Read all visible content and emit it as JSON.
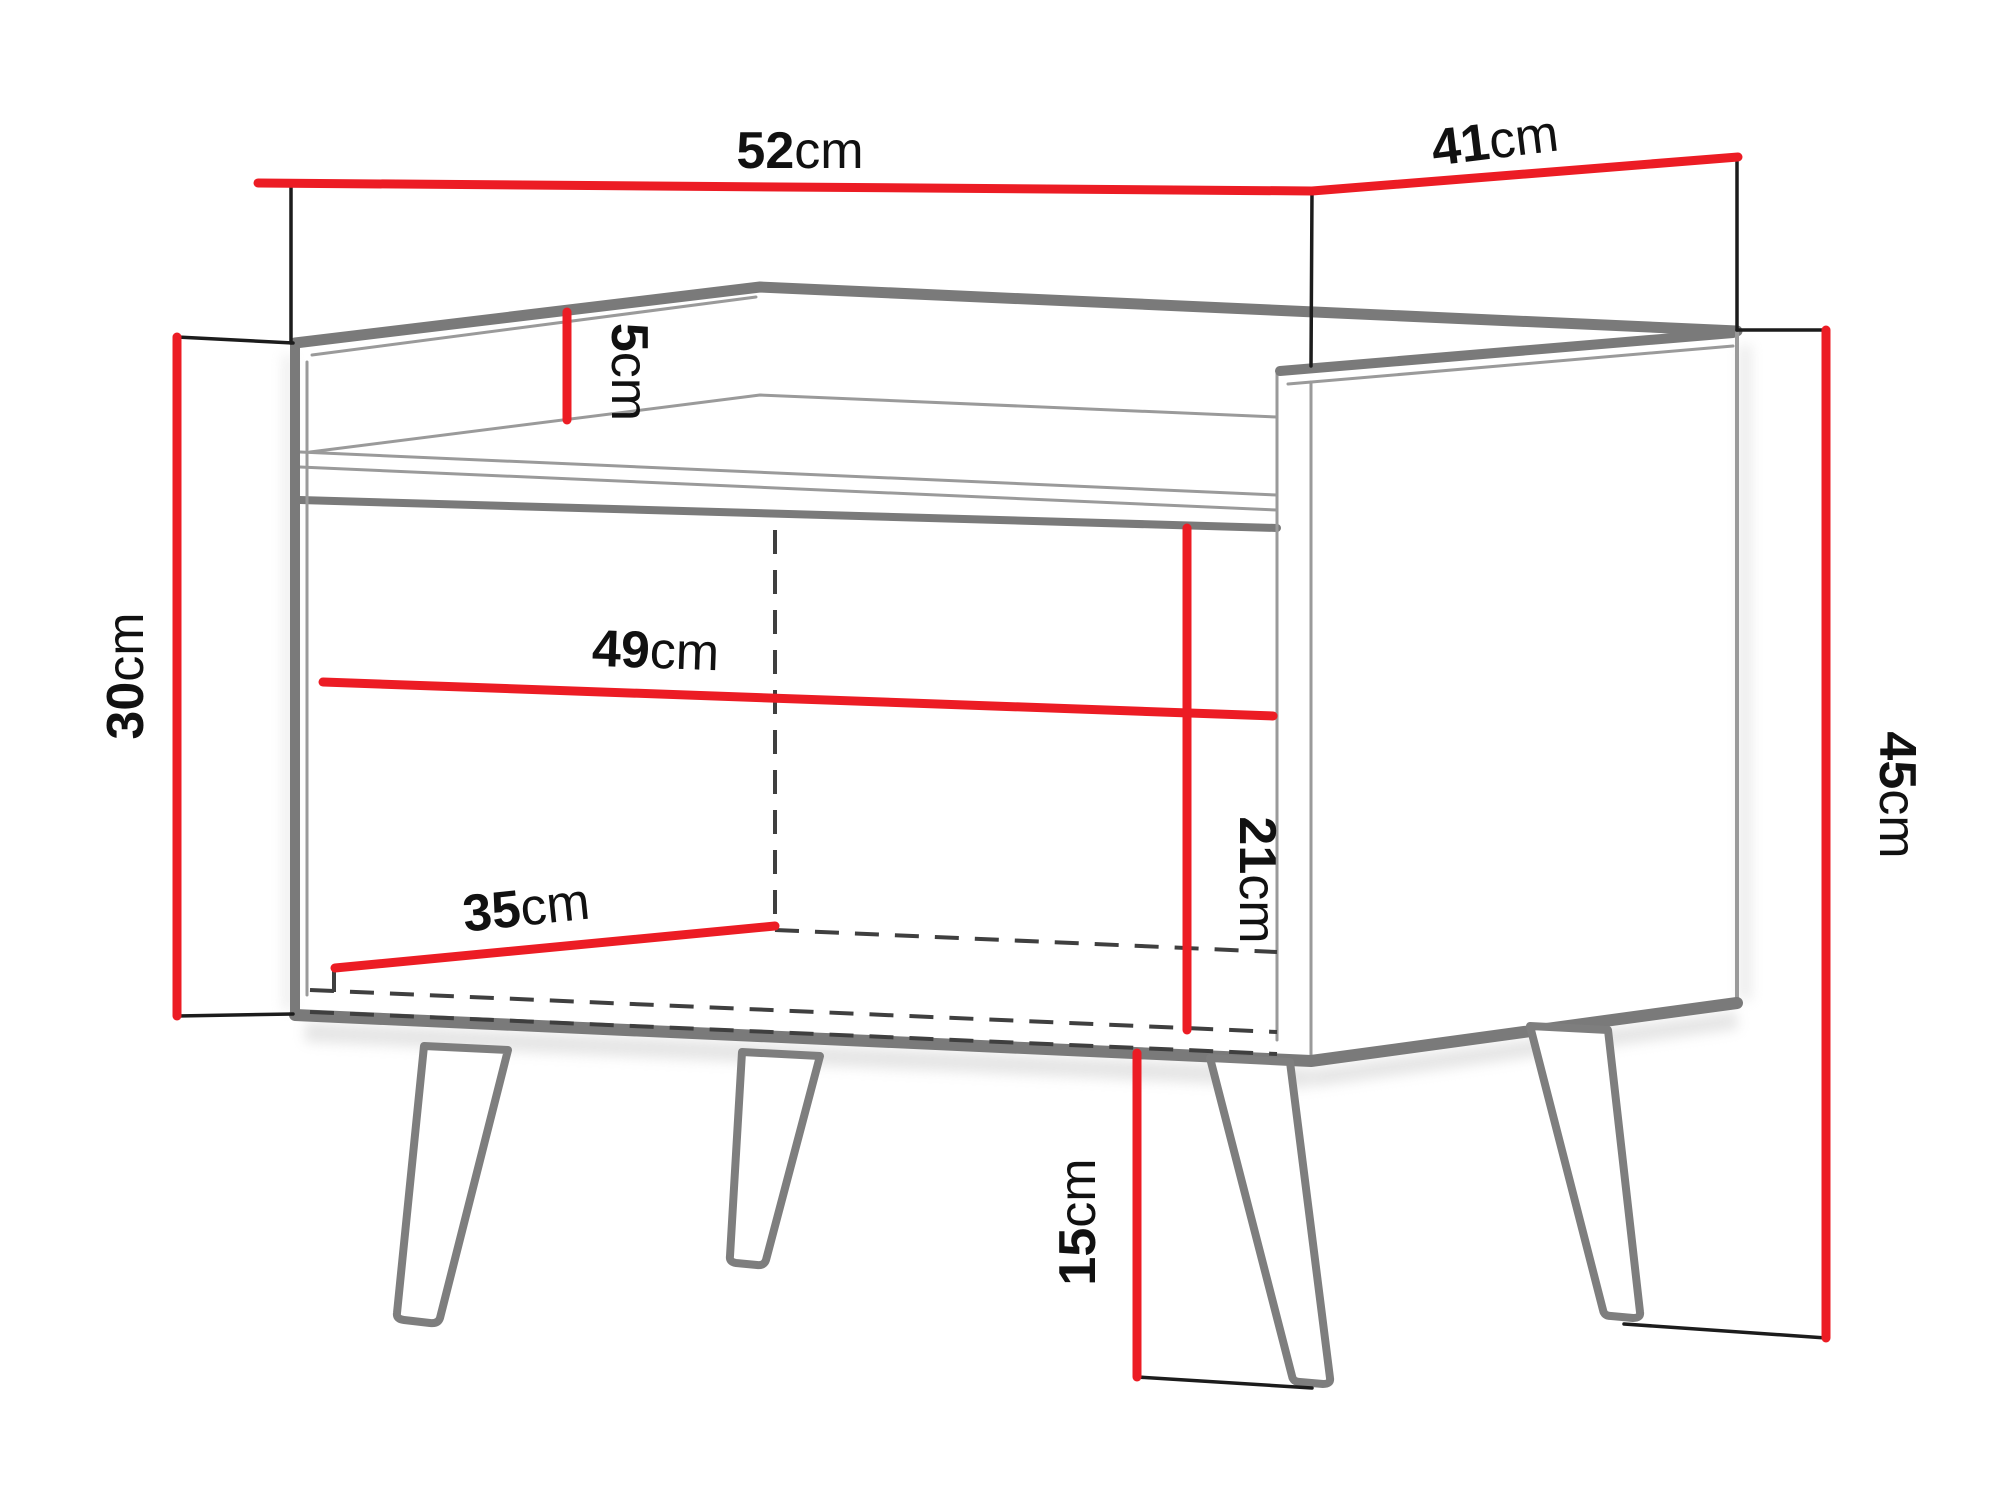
{
  "diagram": {
    "type": "furniture-dimension-drawing",
    "subject": "nightstand with open shelf and four splayed legs",
    "units": "cm",
    "colors": {
      "dimension_line": "#ec1c24",
      "drawing_thick": "#7a7a7a",
      "drawing_thin": "#9a9a9a",
      "extension_line": "#1c1c1c",
      "hidden_dashed": "#3f3f3f",
      "text": "#111111",
      "background": "#ffffff"
    }
  },
  "dimensions": {
    "outer_width": {
      "value": "52",
      "unit": "cm"
    },
    "outer_depth": {
      "value": "41",
      "unit": "cm"
    },
    "top_lip_height": {
      "value": "5",
      "unit": "cm"
    },
    "carcass_height": {
      "value": "30",
      "unit": "cm"
    },
    "inner_width": {
      "value": "49",
      "unit": "cm"
    },
    "inner_height": {
      "value": "21",
      "unit": "cm"
    },
    "inner_depth": {
      "value": "35",
      "unit": "cm"
    },
    "total_height": {
      "value": "45",
      "unit": "cm"
    },
    "leg_height": {
      "value": "15",
      "unit": "cm"
    }
  }
}
